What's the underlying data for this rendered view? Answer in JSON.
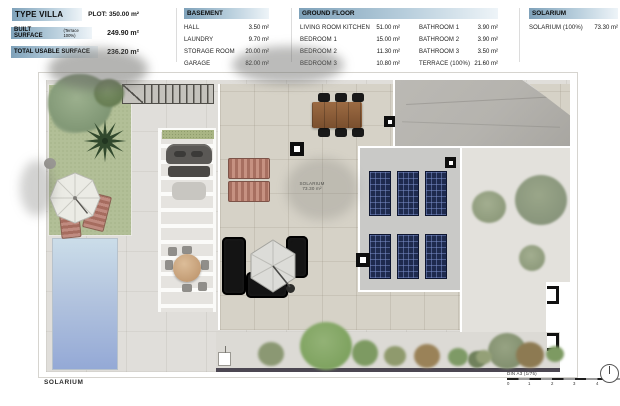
{
  "header": {
    "left": {
      "title": "TYPE VILLA",
      "plot": "PLOT: 350.00 m²",
      "built_label": "BUILT SURFACE",
      "built_sub": "(Terrace 100%)",
      "built_value": "249.90 m²",
      "usable_label": "TOTAL USABLE SURFACE",
      "usable_value": "236.20 m²"
    },
    "basement": {
      "title": "BASEMENT",
      "items": [
        {
          "name": "HALL",
          "value": "3.50 m²"
        },
        {
          "name": "LAUNDRY",
          "value": "9.70 m²"
        },
        {
          "name": "STORAGE ROOM",
          "value": "20.00 m²"
        },
        {
          "name": "GARAGE",
          "value": "82.00 m²"
        }
      ]
    },
    "ground_floor": {
      "title": "GROUND FLOOR",
      "col1": [
        {
          "name": "LIVING ROOM KITCHEN",
          "value": "51.00 m²"
        },
        {
          "name": "BEDROOM 1",
          "value": "15.00 m²"
        },
        {
          "name": "BEDROOM 2",
          "value": "11.30 m²"
        },
        {
          "name": "BEDROOM 3",
          "value": "10.80 m²"
        }
      ],
      "col2": [
        {
          "name": "BATHROOM 1",
          "value": "3.90 m²"
        },
        {
          "name": "BATHROOM 2",
          "value": "3.90 m²"
        },
        {
          "name": "BATHROOM 3",
          "value": "3.50 m²"
        },
        {
          "name": "TERRACE (100%)",
          "value": "21.60 m²"
        }
      ]
    },
    "solarium": {
      "title": "SOLARIUM",
      "items": [
        {
          "name": "SOLARIUM (100%)",
          "value": "73.30 m²"
        }
      ]
    }
  },
  "plan": {
    "area_label": {
      "line1": "SOLARIUM",
      "line2": "73.30 m²"
    },
    "bottom_label": "SOLARIUM"
  },
  "footer": {
    "scale_label": "DIN A3 (1/75)",
    "ticks": [
      "0",
      "1",
      "2",
      "3",
      "4"
    ]
  },
  "colors": {
    "header_bar_start": "#7fa2ba",
    "header_bar_end": "#eef4f8",
    "lawn": "#b2bf97",
    "pool_top": "#cbdde9",
    "pool_bottom": "#94a9d6",
    "concrete": "#e0deda",
    "terrace": "#d6d2c7",
    "roof": "#b5b3ae",
    "solar_panel": "#1e2a4e",
    "boundary_wall": "#4c4752"
  }
}
